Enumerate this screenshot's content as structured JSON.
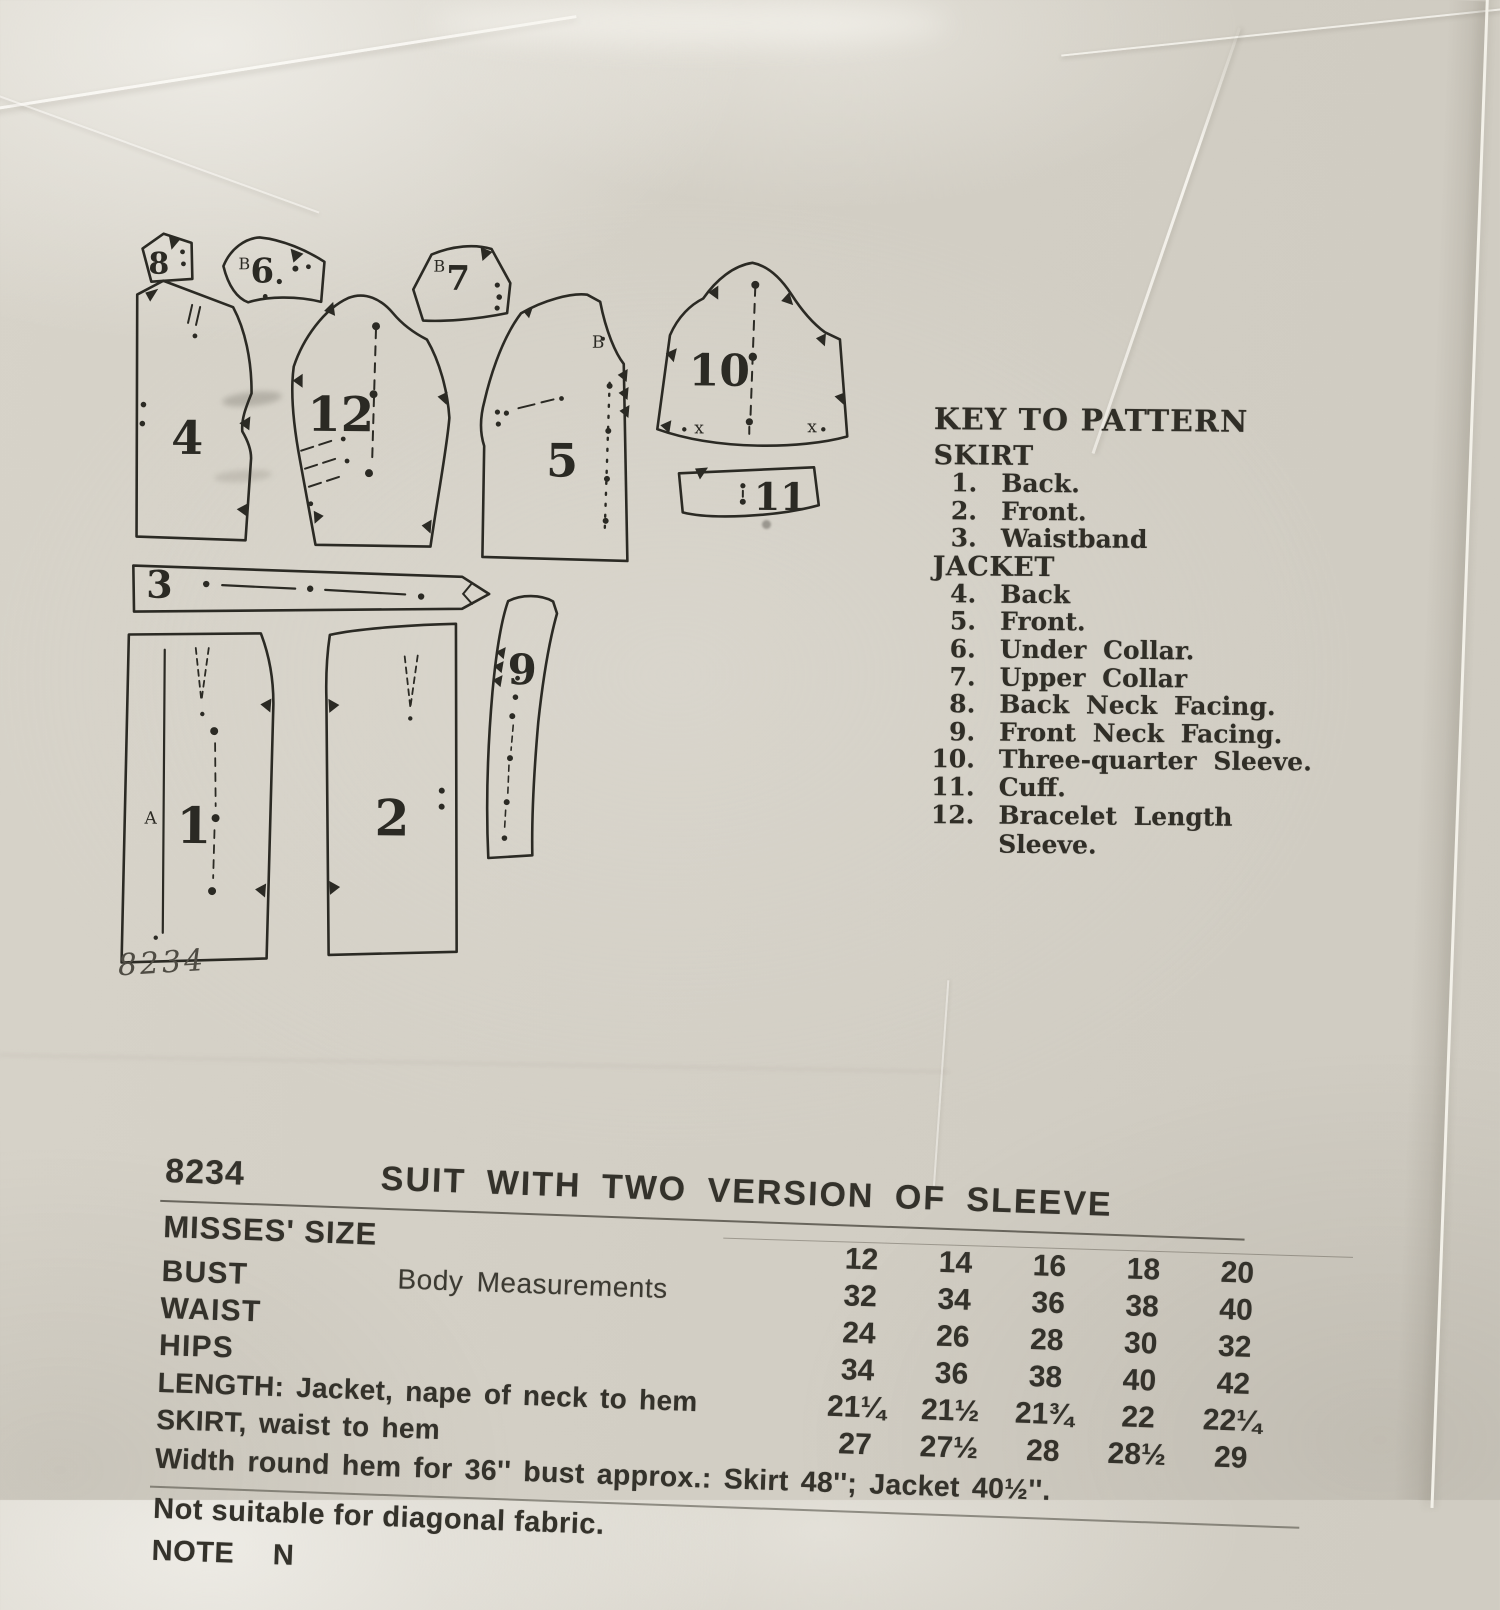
{
  "colors": {
    "paper": "#d3cfc5",
    "ink": "#2b2a24",
    "pencil": "#4f4c44"
  },
  "diagram": {
    "sheet_number": "8234",
    "pieces": [
      {
        "label": "1",
        "letter": "A"
      },
      {
        "label": "2"
      },
      {
        "label": "3"
      },
      {
        "label": "4"
      },
      {
        "label": "5",
        "letter": "B"
      },
      {
        "label": "6",
        "letter": "B"
      },
      {
        "label": "7",
        "letter": "B"
      },
      {
        "label": "8"
      },
      {
        "label": "9"
      },
      {
        "label": "10",
        "x_mark": "x"
      },
      {
        "label": "11"
      },
      {
        "label": "12"
      }
    ]
  },
  "key": {
    "title": "KEY TO PATTERN",
    "sections": [
      {
        "heading": "SKIRT",
        "items": [
          {
            "num": "1.",
            "label": "Back."
          },
          {
            "num": "2.",
            "label": "Front."
          },
          {
            "num": "3.",
            "label": "Waistband"
          }
        ]
      },
      {
        "heading": "JACKET",
        "items": [
          {
            "num": "4.",
            "label": "Back"
          },
          {
            "num": "5.",
            "label": "Front."
          },
          {
            "num": "6.",
            "label": "Under Collar."
          },
          {
            "num": "7.",
            "label": "Upper Collar"
          },
          {
            "num": "8.",
            "label": "Back Neck Facing."
          },
          {
            "num": "9.",
            "label": "Front Neck Facing."
          },
          {
            "num": "10.",
            "label": "Three-quarter Sleeve."
          },
          {
            "num": "11.",
            "label": "Cuff."
          },
          {
            "num": "12.",
            "label": "Bracelet Length Sleeve."
          }
        ]
      }
    ]
  },
  "table": {
    "pattern_number": "8234",
    "title": "SUIT WITH TWO VERSION OF SLEEVE",
    "size_label": "MISSES' SIZE",
    "body_measurements_label": "Body Measurements",
    "sizes": [
      "12",
      "14",
      "16",
      "18",
      "20"
    ],
    "rows": [
      {
        "label": "BUST",
        "values": [
          "32",
          "34",
          "36",
          "38",
          "40"
        ]
      },
      {
        "label": "WAIST",
        "values": [
          "24",
          "26",
          "28",
          "30",
          "32"
        ]
      },
      {
        "label": "HIPS",
        "values": [
          "34",
          "36",
          "38",
          "40",
          "42"
        ]
      },
      {
        "label": "LENGTH: Jacket, nape of neck to hem",
        "values": [
          "21¼",
          "21½",
          "21¾",
          "22",
          "22¼"
        ]
      },
      {
        "label": "SKIRT, waist to hem",
        "values": [
          "27",
          "27½",
          "28",
          "28½",
          "29"
        ]
      }
    ],
    "width_note": "Width round hem for 36'' bust approx.: Skirt 48''; Jacket 40½''.",
    "not_suitable": "Not suitable for diagonal fabric.",
    "note_partial": "NOTE N"
  }
}
